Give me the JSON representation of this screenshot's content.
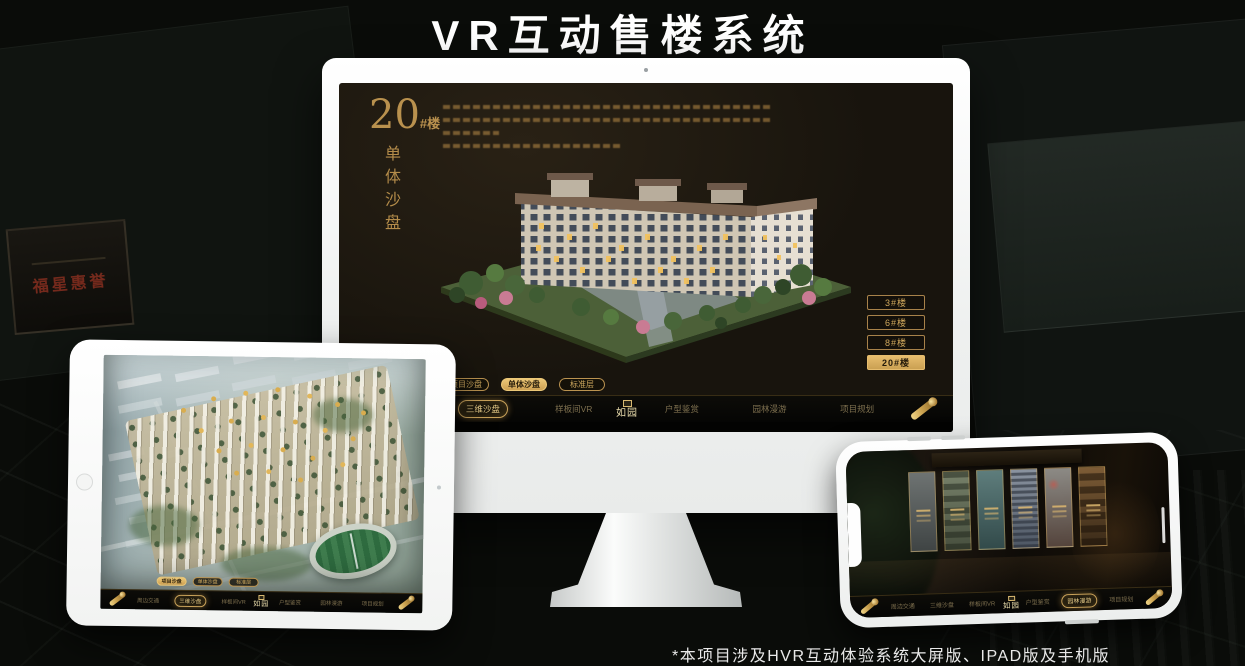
{
  "page": {
    "title": "VR互动售楼系统",
    "footnote": "*本项目涉及HVR互动体验系统大屏版、IPAD版及手机版"
  },
  "background": {
    "plaque_text": "福星惠誉"
  },
  "colors": {
    "gold": "#c99d52",
    "gold_bright": "#ecc878",
    "screen_bg": "#18140d",
    "nav_bg": "#080806",
    "title_text": "#ffffff"
  },
  "monitor": {
    "headline": {
      "number": "20",
      "unit": "#楼",
      "vertical": "单体沙盘"
    },
    "building_buttons": [
      {
        "label": "3#楼",
        "active": false
      },
      {
        "label": "6#楼",
        "active": false
      },
      {
        "label": "8#楼",
        "active": false
      },
      {
        "label": "20#楼",
        "active": true
      }
    ],
    "mode_tabs": [
      {
        "label": "项目沙盘",
        "active": false
      },
      {
        "label": "单体沙盘",
        "active": true
      },
      {
        "label": "标准层",
        "active": false
      }
    ],
    "nav": {
      "left": [
        {
          "label": "周边交通",
          "active": false
        },
        {
          "label": "三维沙盘",
          "active": true
        },
        {
          "label": "样板间VR",
          "active": false
        }
      ],
      "logo": "如园",
      "right": [
        {
          "label": "户型鉴赏",
          "active": false
        },
        {
          "label": "园林漫游",
          "active": false
        },
        {
          "label": "项目规划",
          "active": false
        }
      ]
    }
  },
  "tablet": {
    "mode_tabs": [
      {
        "label": "项目沙盘",
        "active": true
      },
      {
        "label": "单体沙盘",
        "active": false
      },
      {
        "label": "标准层",
        "active": false
      }
    ],
    "nav": {
      "left": [
        {
          "label": "周边交通",
          "active": false
        },
        {
          "label": "三维沙盘",
          "active": true
        },
        {
          "label": "样板间VR",
          "active": false
        }
      ],
      "logo": "如园",
      "right": [
        {
          "label": "户型鉴赏",
          "active": false
        },
        {
          "label": "园林漫游",
          "active": false
        },
        {
          "label": "项目规划",
          "active": false
        }
      ]
    }
  },
  "phone": {
    "nav": {
      "left": [
        {
          "label": "周边交通",
          "active": false
        },
        {
          "label": "三维沙盘",
          "active": false
        },
        {
          "label": "样板间VR",
          "active": false
        }
      ],
      "logo": "如园",
      "right": [
        {
          "label": "户型鉴赏",
          "active": false
        },
        {
          "label": "园林漫游",
          "active": true
        },
        {
          "label": "项目规划",
          "active": false
        }
      ]
    }
  }
}
